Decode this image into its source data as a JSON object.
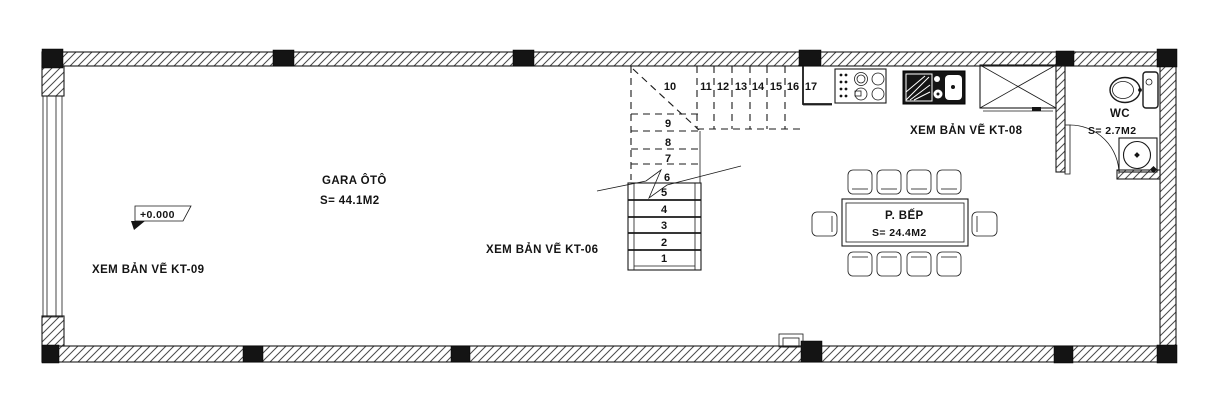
{
  "drawing_title": "floor-plan-ground",
  "colors": {
    "line": "#1a1a1a",
    "wall_hatch": "#4a4a4a",
    "column_fill": "#141414",
    "background": "#ffffff"
  },
  "rooms": {
    "garage": {
      "name": "GARA ÔTÔ",
      "area": "S= 44.1M2"
    },
    "kitchen_dining": {
      "name": "P. BẾP",
      "area": "S= 24.4M2"
    },
    "wc": {
      "name": "WC",
      "area": "S= 2.7M2"
    }
  },
  "annotations": {
    "see_drawing_kt09": "XEM BẢN VẼ KT-09",
    "see_drawing_kt06": "XEM BẢN VẼ KT-06",
    "see_drawing_kt08": "XEM BẢN VẼ KT-08",
    "elevation": "+0.000"
  },
  "stairs": {
    "steps": [
      "1",
      "2",
      "3",
      "4",
      "5",
      "6",
      "7",
      "8",
      "9",
      "10",
      "11",
      "12",
      "13",
      "14",
      "15",
      "16",
      "17"
    ]
  }
}
